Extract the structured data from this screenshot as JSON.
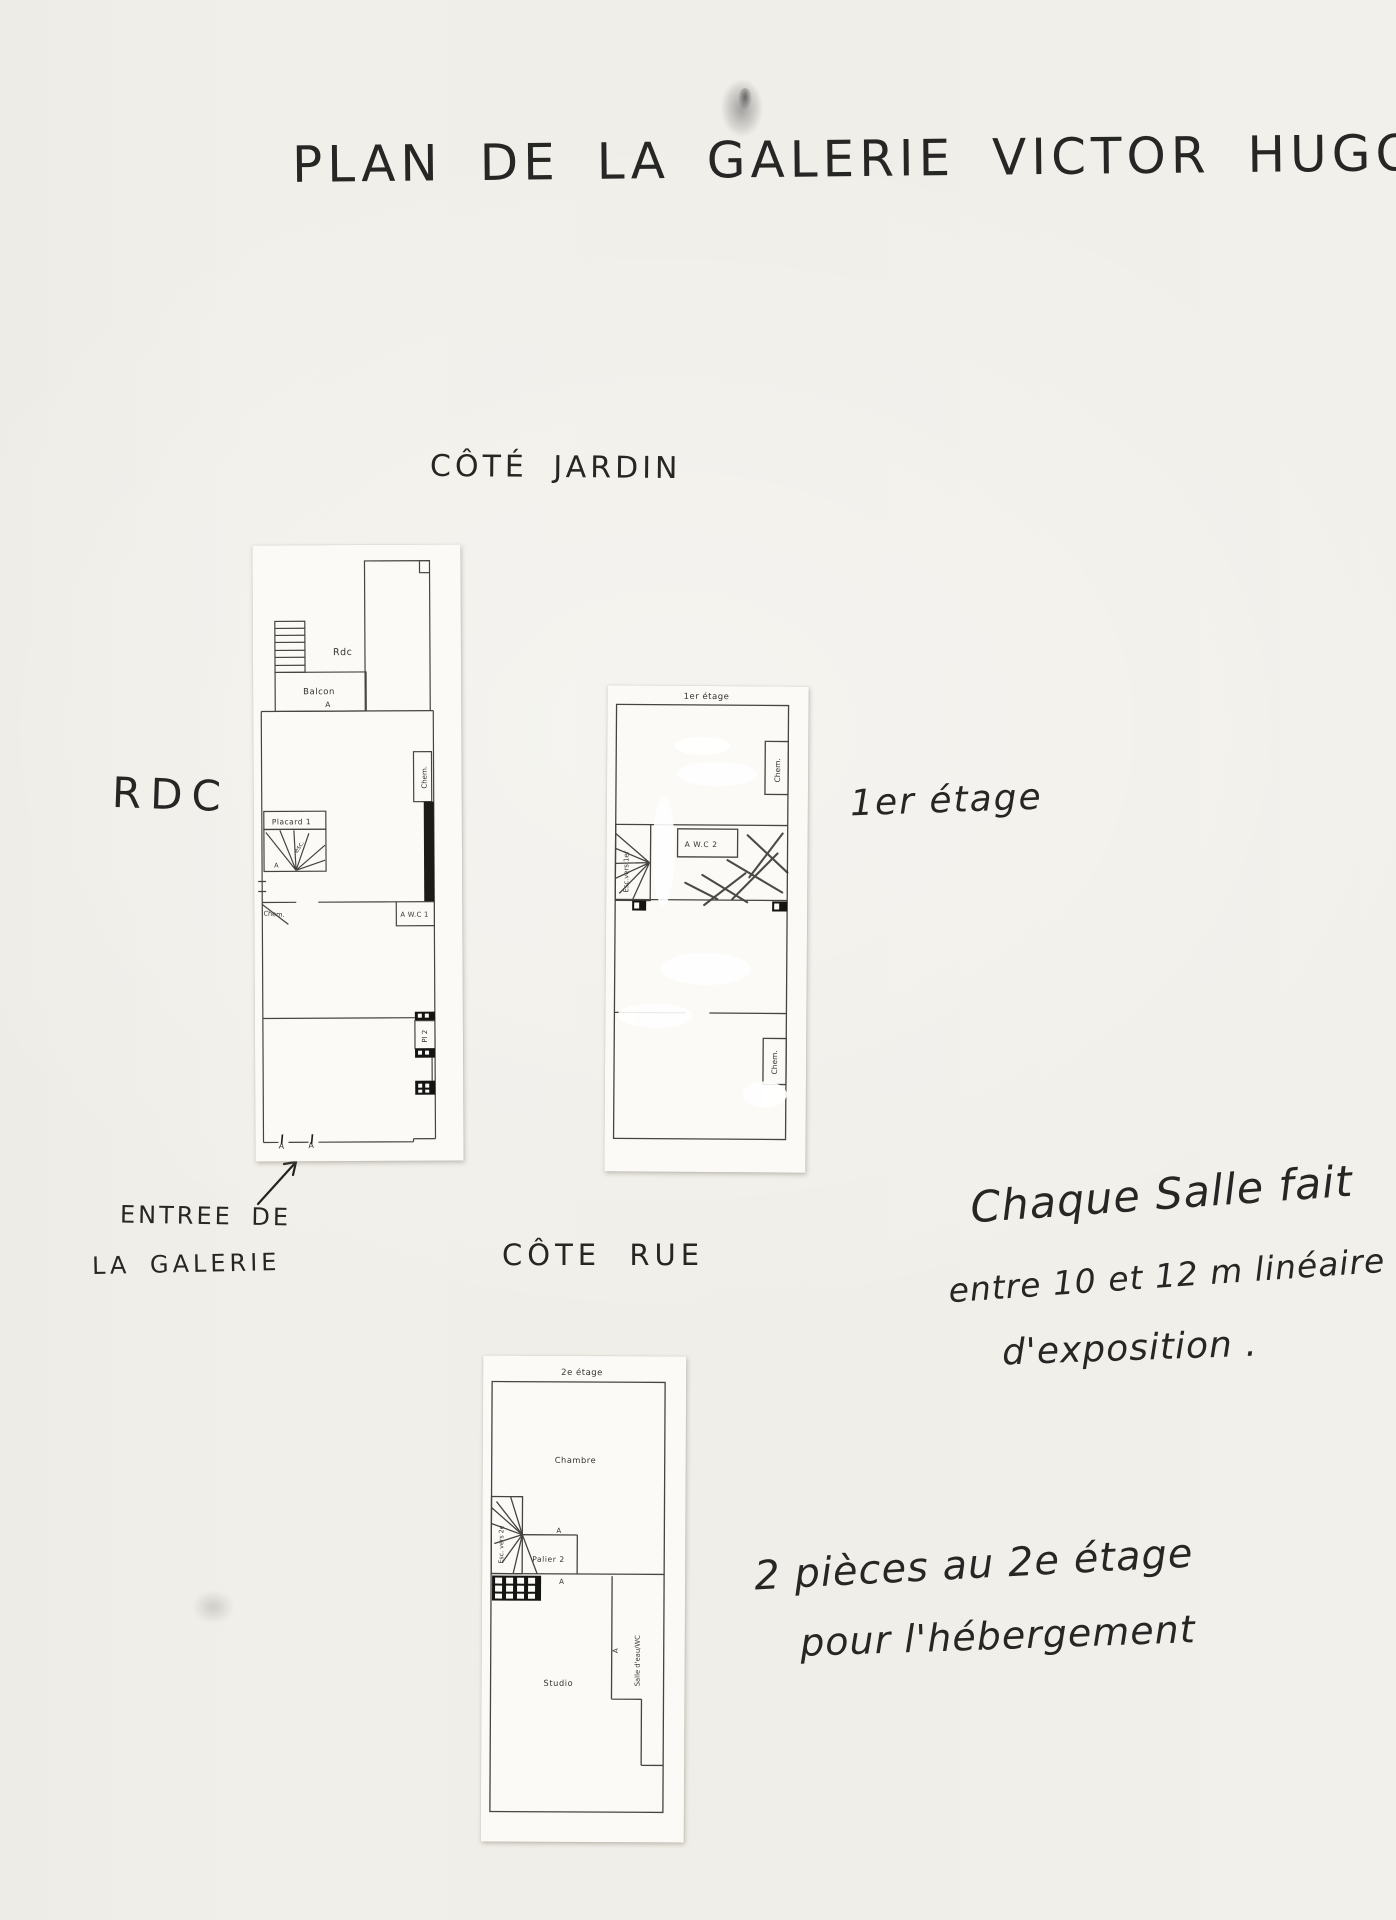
{
  "handwriting": {
    "title": "PLAN DE LA GALERIE VICTOR HUGO",
    "cote_jardin": "CÔTÉ JARDIN",
    "rdc_label": "RDC",
    "etage1_label": "1er étage",
    "entree_line1": "ENTREE DE",
    "entree_line2": "LA GALERIE",
    "cote_rue": "CÔTE RUE",
    "note_salle": {
      "line1": "Chaque Salle fait",
      "line2": "entre 10 et 12 m linéaire",
      "line3": "d'exposition ."
    },
    "note_2e": {
      "line1": "2 pièces au 2e étage",
      "line2": "pour l'hébergement"
    }
  },
  "plans": {
    "rdc": {
      "labels": {
        "rdc": "Rdc",
        "balcon": "Balcon",
        "balcon_door": "A",
        "chem_right": "Chem.",
        "wc": "A W.C 1",
        "placard": "Placard 1",
        "esc": "esc.",
        "esc_door": "A",
        "chem_left": "Chem.",
        "pl2": "Pl 2",
        "door_left": "A",
        "door_right": "A"
      }
    },
    "etage1": {
      "title": "1er étage",
      "labels": {
        "chem_top": "Chem.",
        "esc": "Esc.vers 1er",
        "wc": "A W.C 2",
        "chem_bottom": "Chem."
      }
    },
    "etage2": {
      "title": "2e étage",
      "labels": {
        "chambre": "Chambre",
        "esc": "Esc. vers 2e",
        "palier": "Palier 2",
        "palier_door": "A",
        "hatch_door": "A",
        "wc_door": "A",
        "salle_eau": "Salle d'eau/WC",
        "studio": "Studio"
      }
    }
  }
}
